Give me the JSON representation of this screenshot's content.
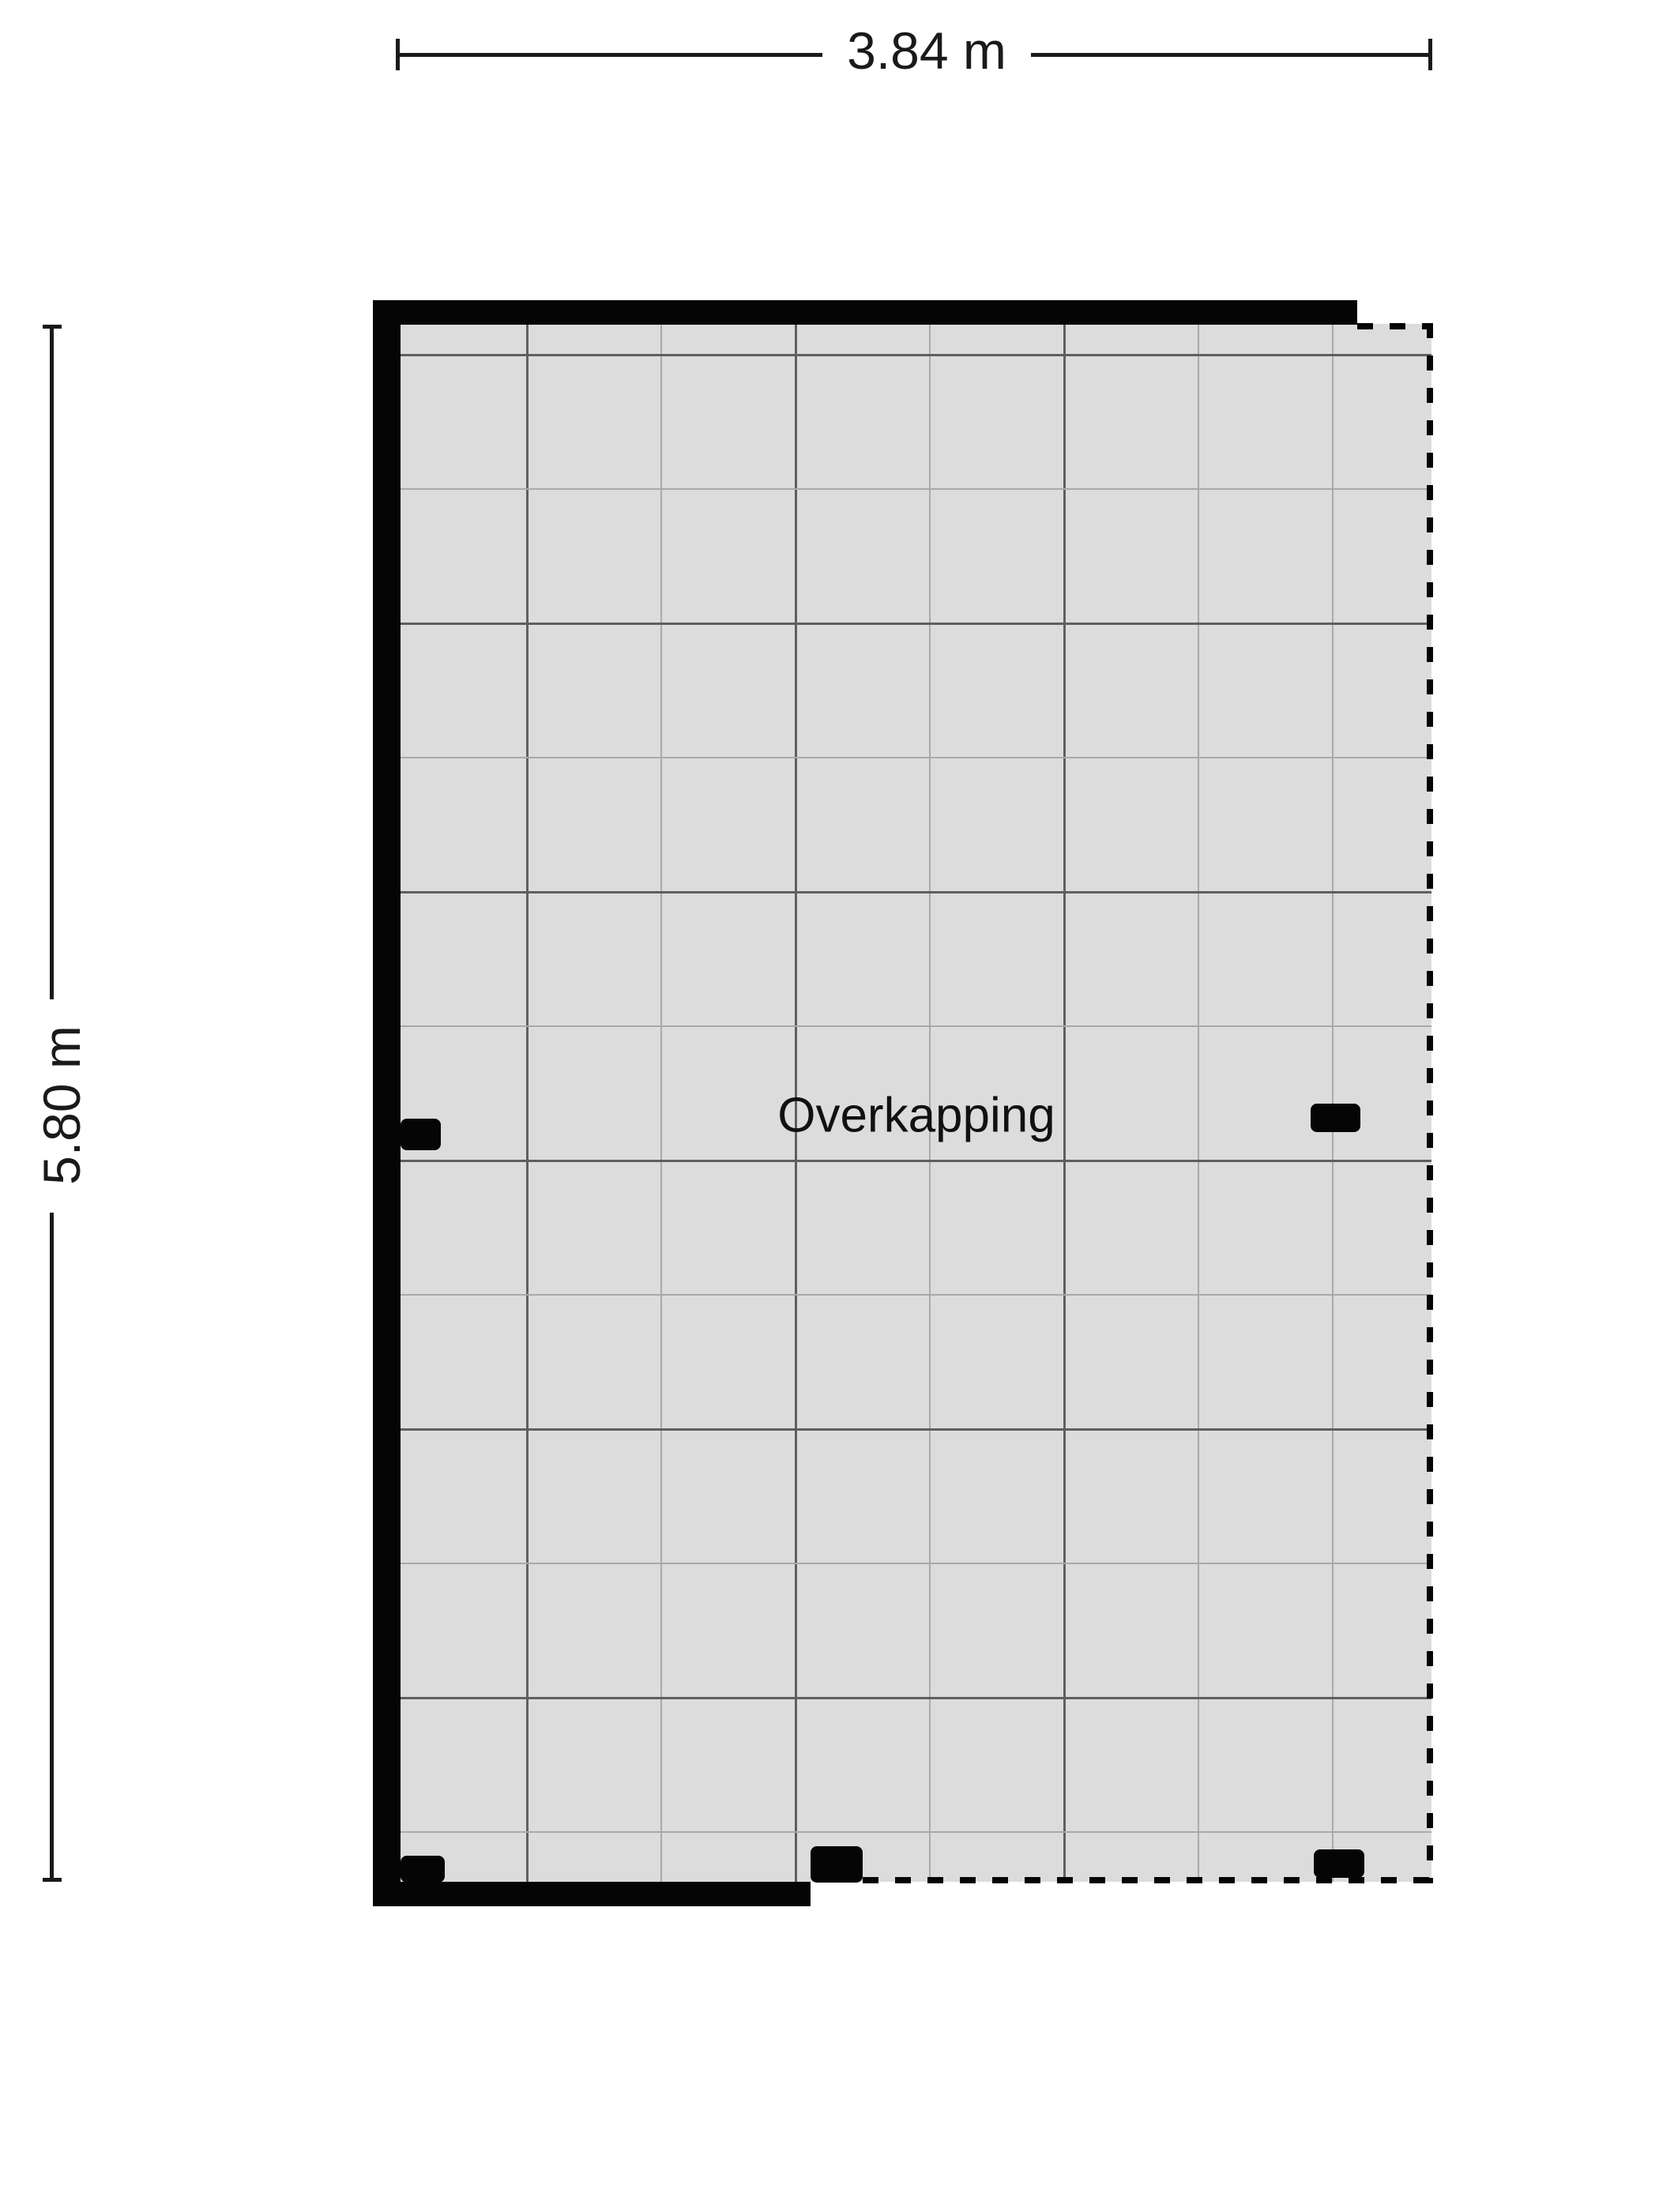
{
  "floorplan": {
    "room_label": "Overkapping",
    "dimension_width": "3.84 m",
    "dimension_height": "5.80 m",
    "colors": {
      "wall": "#050505",
      "floor_fill": "#dcdcdc",
      "grid_dark": "#5f5f5f",
      "grid_light": "#a9a9a9",
      "dimension_text": "#1a1a1a",
      "background": "#ffffff"
    }
  }
}
